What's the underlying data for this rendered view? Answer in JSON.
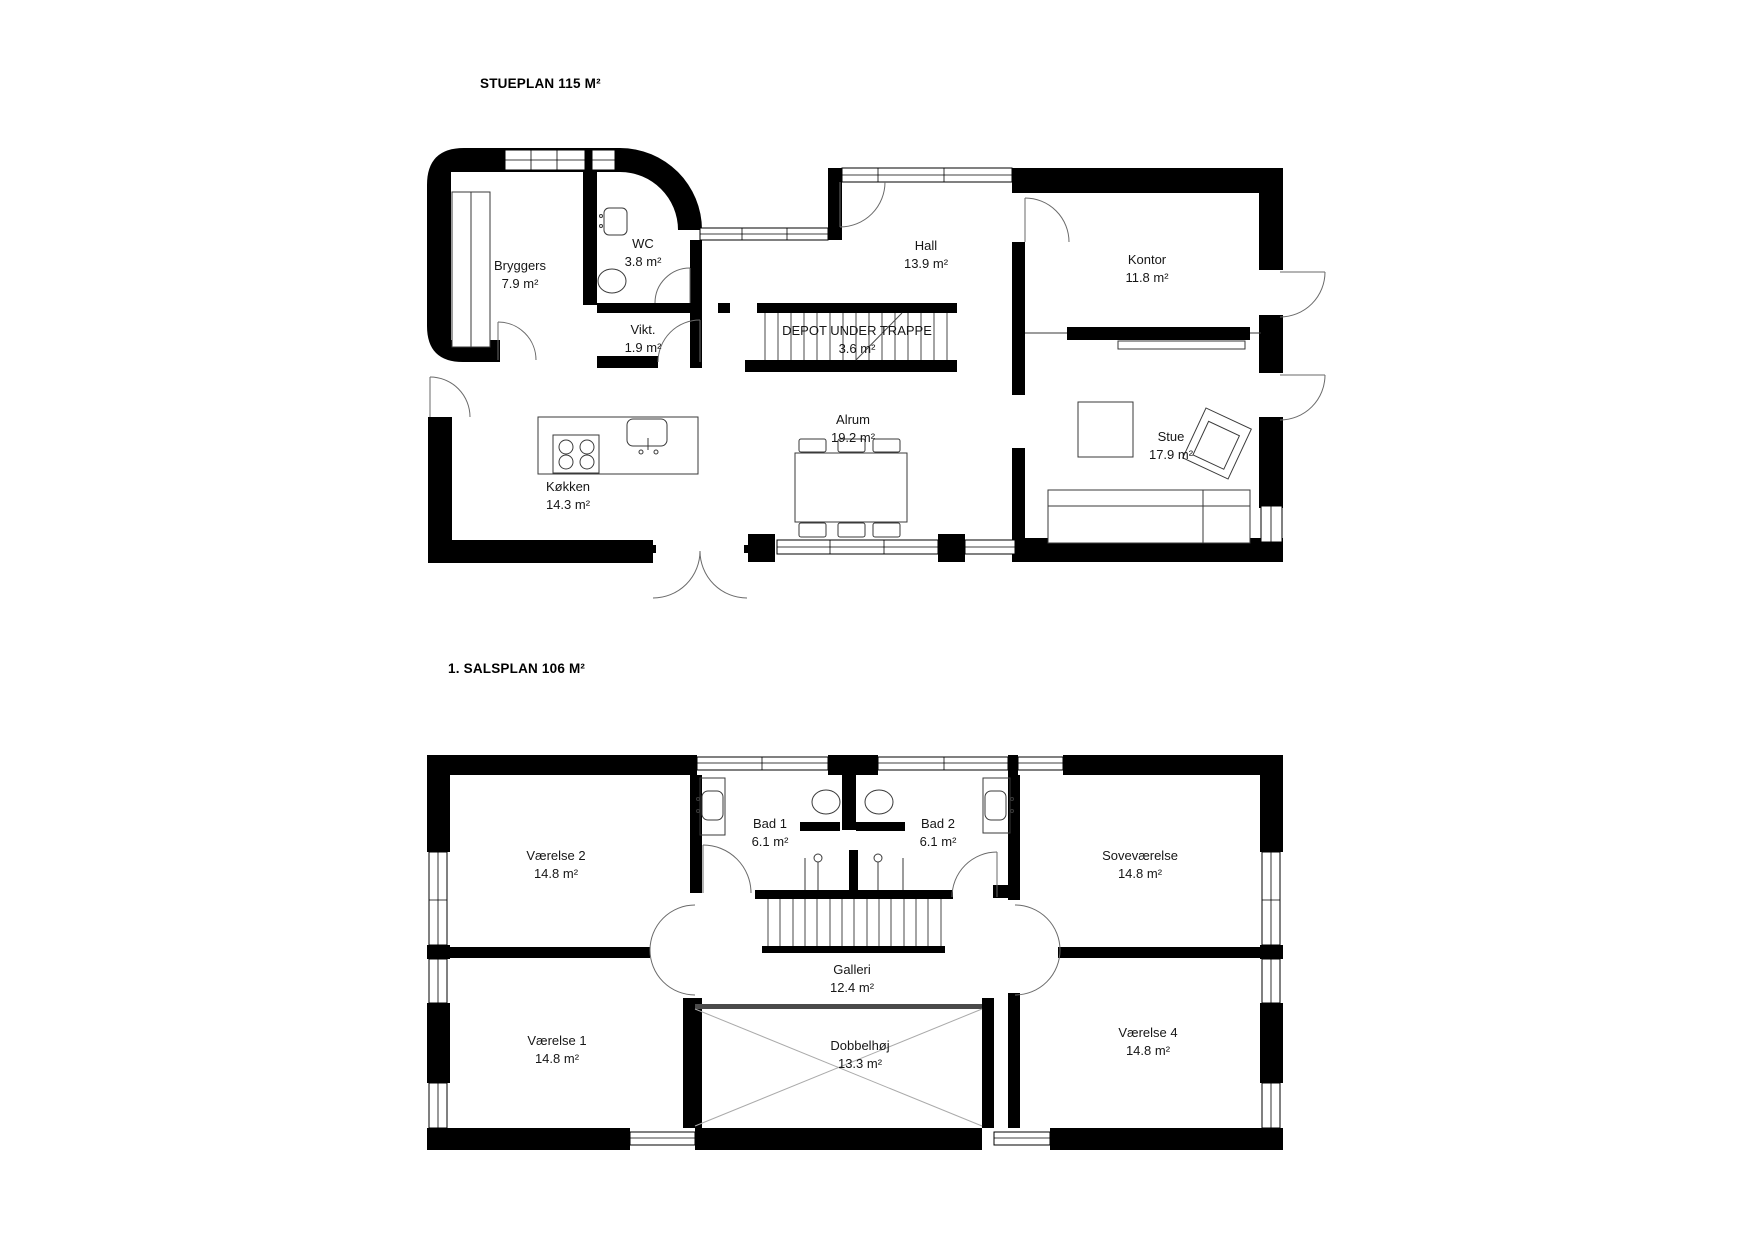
{
  "colors": {
    "wall": "#000000",
    "background": "#ffffff",
    "line": "#444444"
  },
  "plans": [
    {
      "title": "STUEPLAN 115 M²",
      "rooms": [
        {
          "name": "Bryggers",
          "area": "7.9 m²"
        },
        {
          "name": "WC",
          "area": "3.8 m²"
        },
        {
          "name": "Vikt.",
          "area": "1.9 m²"
        },
        {
          "name": "Hall",
          "area": "13.9 m²"
        },
        {
          "name": "DEPOT UNDER TRAPPE",
          "area": "3.6 m²"
        },
        {
          "name": "Kontor",
          "area": "11.8 m²"
        },
        {
          "name": "Alrum",
          "area": "19.2 m²"
        },
        {
          "name": "Køkken",
          "area": "14.3 m²"
        },
        {
          "name": "Stue",
          "area": "17.9 m²"
        }
      ]
    },
    {
      "title": "1. SALSPLAN 106 M²",
      "rooms": [
        {
          "name": "Værelse 2",
          "area": "14.8 m²"
        },
        {
          "name": "Bad 1",
          "area": "6.1 m²"
        },
        {
          "name": "Bad 2",
          "area": "6.1 m²"
        },
        {
          "name": "Soveværelse",
          "area": "14.8 m²"
        },
        {
          "name": "Galleri",
          "area": "12.4 m²"
        },
        {
          "name": "Værelse 1",
          "area": "14.8 m²"
        },
        {
          "name": "Dobbelhøj",
          "area": "13.3 m²"
        },
        {
          "name": "Værelse 4",
          "area": "14.8 m²"
        }
      ]
    }
  ]
}
